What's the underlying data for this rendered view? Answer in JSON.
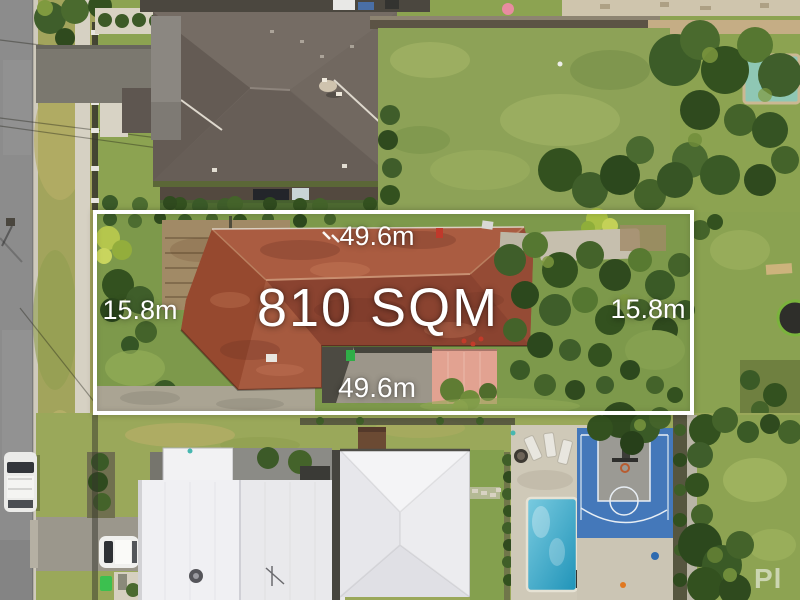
{
  "scene": {
    "description": "Aerial drone photo of suburban lots: highlighted 810 sqm property with terracotta-tile roof house, neighbouring homes above and below with swimming pools, basketball court, lawns, trees and street at left"
  },
  "property_overlay": {
    "area_label": "810 SQM",
    "frontage_top": "49.6m",
    "frontage_bottom": "49.6m",
    "side_left": "15.8m",
    "side_right": "15.8m"
  },
  "watermark": {
    "text": "Pl"
  },
  "colors": {
    "boundary_and_text": "#ffffff",
    "terracotta_roof": "#9d5038",
    "top_house_roof": "#6e655e",
    "white_roof": "#e9e9ec",
    "lawn": "#8da257",
    "trees": "#33511f",
    "pool_top": "#b5e2e7",
    "pool_bottom": "#2ba4c6",
    "basketball_court": "#4478ba",
    "road": "#8c8c8c",
    "salmon_patio": "#e2a291"
  }
}
